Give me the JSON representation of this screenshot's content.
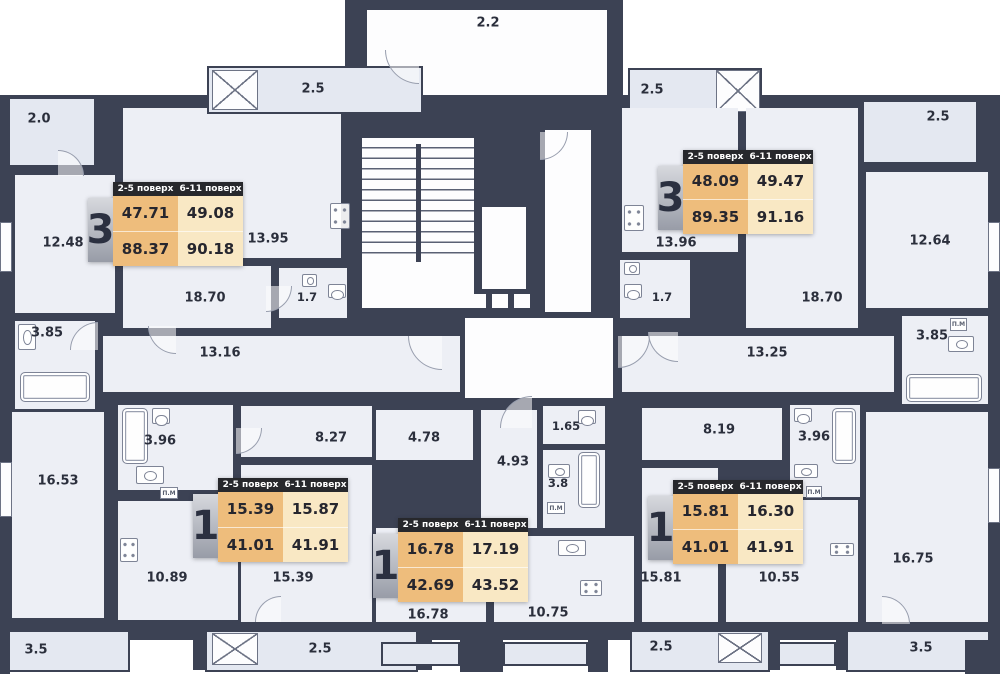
{
  "badge_header": {
    "col1": "2-5 поверх",
    "col2": "6-11 поверх"
  },
  "apartments": [
    {
      "rooms": "3",
      "f25_top": "47.71",
      "f25_bot": "88.37",
      "f611_top": "49.08",
      "f611_bot": "90.18"
    },
    {
      "rooms": "3",
      "f25_top": "48.09",
      "f25_bot": "89.35",
      "f611_top": "49.47",
      "f611_bot": "91.16"
    },
    {
      "rooms": "1",
      "f25_top": "15.39",
      "f25_bot": "41.01",
      "f611_top": "15.87",
      "f611_bot": "41.91"
    },
    {
      "rooms": "1",
      "f25_top": "16.78",
      "f25_bot": "42.69",
      "f611_top": "17.19",
      "f611_bot": "43.52"
    },
    {
      "rooms": "1",
      "f25_top": "15.81",
      "f25_bot": "41.01",
      "f611_top": "16.30",
      "f611_bot": "41.91"
    }
  ],
  "rooms": {
    "vestibule": "2.2",
    "balc_top_left": "2.5",
    "balc_top_right": "2.5",
    "balc_far_left": "2.0",
    "balc_far_right": "2.5",
    "l_room1": "12.48",
    "l_kitchen": "13.95",
    "l_living": "18.70",
    "l_wc": "1.7",
    "l_hall": "13.16",
    "l_bath": "3.85",
    "l_room2": "16.53",
    "r_kitchen": "13.96",
    "r_room1": "12.64",
    "r_wc": "1.7",
    "r_living": "18.70",
    "r_hall": "13.25",
    "r_bath": "3.85",
    "r_room2": "16.75",
    "bl_bath": "3.96",
    "bl_hall": "8.27",
    "bl_kitchen": "10.89",
    "bl_room": "15.39",
    "bl_balc1": "3.5",
    "bl_balc2": "2.5",
    "bm_hall1": "4.78",
    "bm_hall2": "4.93",
    "bm_wc": "1.65",
    "bm_bath": "3.8",
    "bm_room": "16.78",
    "bm_kitchen": "10.75",
    "br_hall": "8.19",
    "br_bath": "3.96",
    "br_room": "15.81",
    "br_kitchen": "10.55",
    "br_balc1": "2.5",
    "br_balc2": "3.5"
  },
  "fixtures": {
    "washing_machine": "П.М"
  },
  "colors": {
    "wall": "#3c4254",
    "room_fill": "#edeff5",
    "balcony_fill": "#e4e8f1",
    "badge_col1": "#eebd7c",
    "badge_col2": "#f9e8c4",
    "badge_header_bg": "#27282c",
    "text": "#2b2f3c"
  }
}
